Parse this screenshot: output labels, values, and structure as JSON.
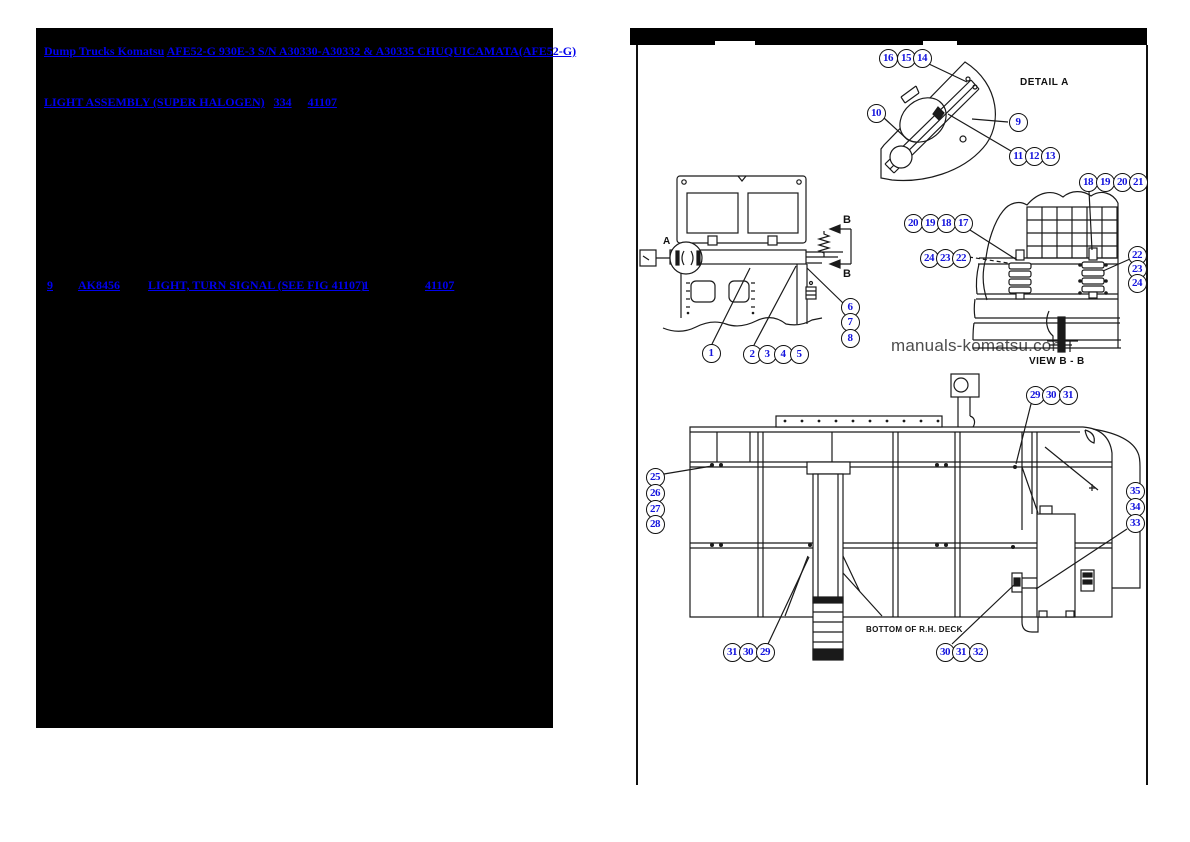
{
  "left_panel": {
    "breadcrumb": {
      "brand": "Dump Trucks Komatsu",
      "model": "AFE52-G 930E-3 S/N A30330-A30332 & A30335 CHUQUICAMATA(AFE52-G)"
    },
    "figure": {
      "name": "LIGHT ASSEMBLY (SUPER HALOGEN)",
      "sheet": "334",
      "fig": "41107"
    },
    "part": {
      "ref": "9",
      "part_no": "AK8456",
      "desc": "LIGHT, TURN SIGNAL (SEE FIG 41107)",
      "qty": "1",
      "fig": "41107"
    }
  },
  "right_panel": {
    "labels": {
      "detail_a": "DETAIL A",
      "view_bb": "VIEW B - B",
      "bottom_deck": "BOTTOM OF R.H. DECK"
    },
    "markers": {
      "a": "A",
      "b_top": "B",
      "b_bottom": "B"
    },
    "watermark": "manuals-komatsu.com",
    "colors": {
      "link": "#0101ee",
      "callout": "#1414dd",
      "line": "#1a1a1a",
      "watermark": "#4d4d4d"
    },
    "callouts": [
      {
        "n": "16",
        "x": 888,
        "y": 58
      },
      {
        "n": "15",
        "x": 906,
        "y": 58
      },
      {
        "n": "14",
        "x": 922,
        "y": 58
      },
      {
        "n": "10",
        "x": 876,
        "y": 113
      },
      {
        "n": "9",
        "x": 1018,
        "y": 122
      },
      {
        "n": "11",
        "x": 1018,
        "y": 156
      },
      {
        "n": "12",
        "x": 1034,
        "y": 156
      },
      {
        "n": "13",
        "x": 1050,
        "y": 156
      },
      {
        "n": "18",
        "x": 1088,
        "y": 182
      },
      {
        "n": "19",
        "x": 1105,
        "y": 182
      },
      {
        "n": "20",
        "x": 1122,
        "y": 182
      },
      {
        "n": "21",
        "x": 1138,
        "y": 182
      },
      {
        "n": "20",
        "x": 913,
        "y": 223
      },
      {
        "n": "19",
        "x": 930,
        "y": 223
      },
      {
        "n": "18",
        "x": 946,
        "y": 223
      },
      {
        "n": "17",
        "x": 963,
        "y": 223
      },
      {
        "n": "24",
        "x": 929,
        "y": 258
      },
      {
        "n": "23",
        "x": 945,
        "y": 258
      },
      {
        "n": "22",
        "x": 961,
        "y": 258
      },
      {
        "n": "22",
        "x": 1137,
        "y": 255
      },
      {
        "n": "23",
        "x": 1137,
        "y": 269
      },
      {
        "n": "24",
        "x": 1137,
        "y": 283
      },
      {
        "n": "6",
        "x": 850,
        "y": 307
      },
      {
        "n": "7",
        "x": 850,
        "y": 322
      },
      {
        "n": "8",
        "x": 850,
        "y": 338
      },
      {
        "n": "1",
        "x": 711,
        "y": 353
      },
      {
        "n": "2",
        "x": 752,
        "y": 354
      },
      {
        "n": "3",
        "x": 767,
        "y": 354
      },
      {
        "n": "4",
        "x": 783,
        "y": 354
      },
      {
        "n": "5",
        "x": 799,
        "y": 354
      },
      {
        "n": "29",
        "x": 1035,
        "y": 395
      },
      {
        "n": "30",
        "x": 1051,
        "y": 395
      },
      {
        "n": "31",
        "x": 1068,
        "y": 395
      },
      {
        "n": "25",
        "x": 655,
        "y": 477
      },
      {
        "n": "26",
        "x": 655,
        "y": 493
      },
      {
        "n": "27",
        "x": 655,
        "y": 509
      },
      {
        "n": "28",
        "x": 655,
        "y": 524
      },
      {
        "n": "35",
        "x": 1135,
        "y": 491
      },
      {
        "n": "34",
        "x": 1135,
        "y": 507
      },
      {
        "n": "33",
        "x": 1135,
        "y": 523
      },
      {
        "n": "31",
        "x": 732,
        "y": 652
      },
      {
        "n": "30",
        "x": 748,
        "y": 652
      },
      {
        "n": "29",
        "x": 765,
        "y": 652
      },
      {
        "n": "30",
        "x": 945,
        "y": 652
      },
      {
        "n": "31",
        "x": 961,
        "y": 652
      },
      {
        "n": "32",
        "x": 978,
        "y": 652
      }
    ]
  }
}
